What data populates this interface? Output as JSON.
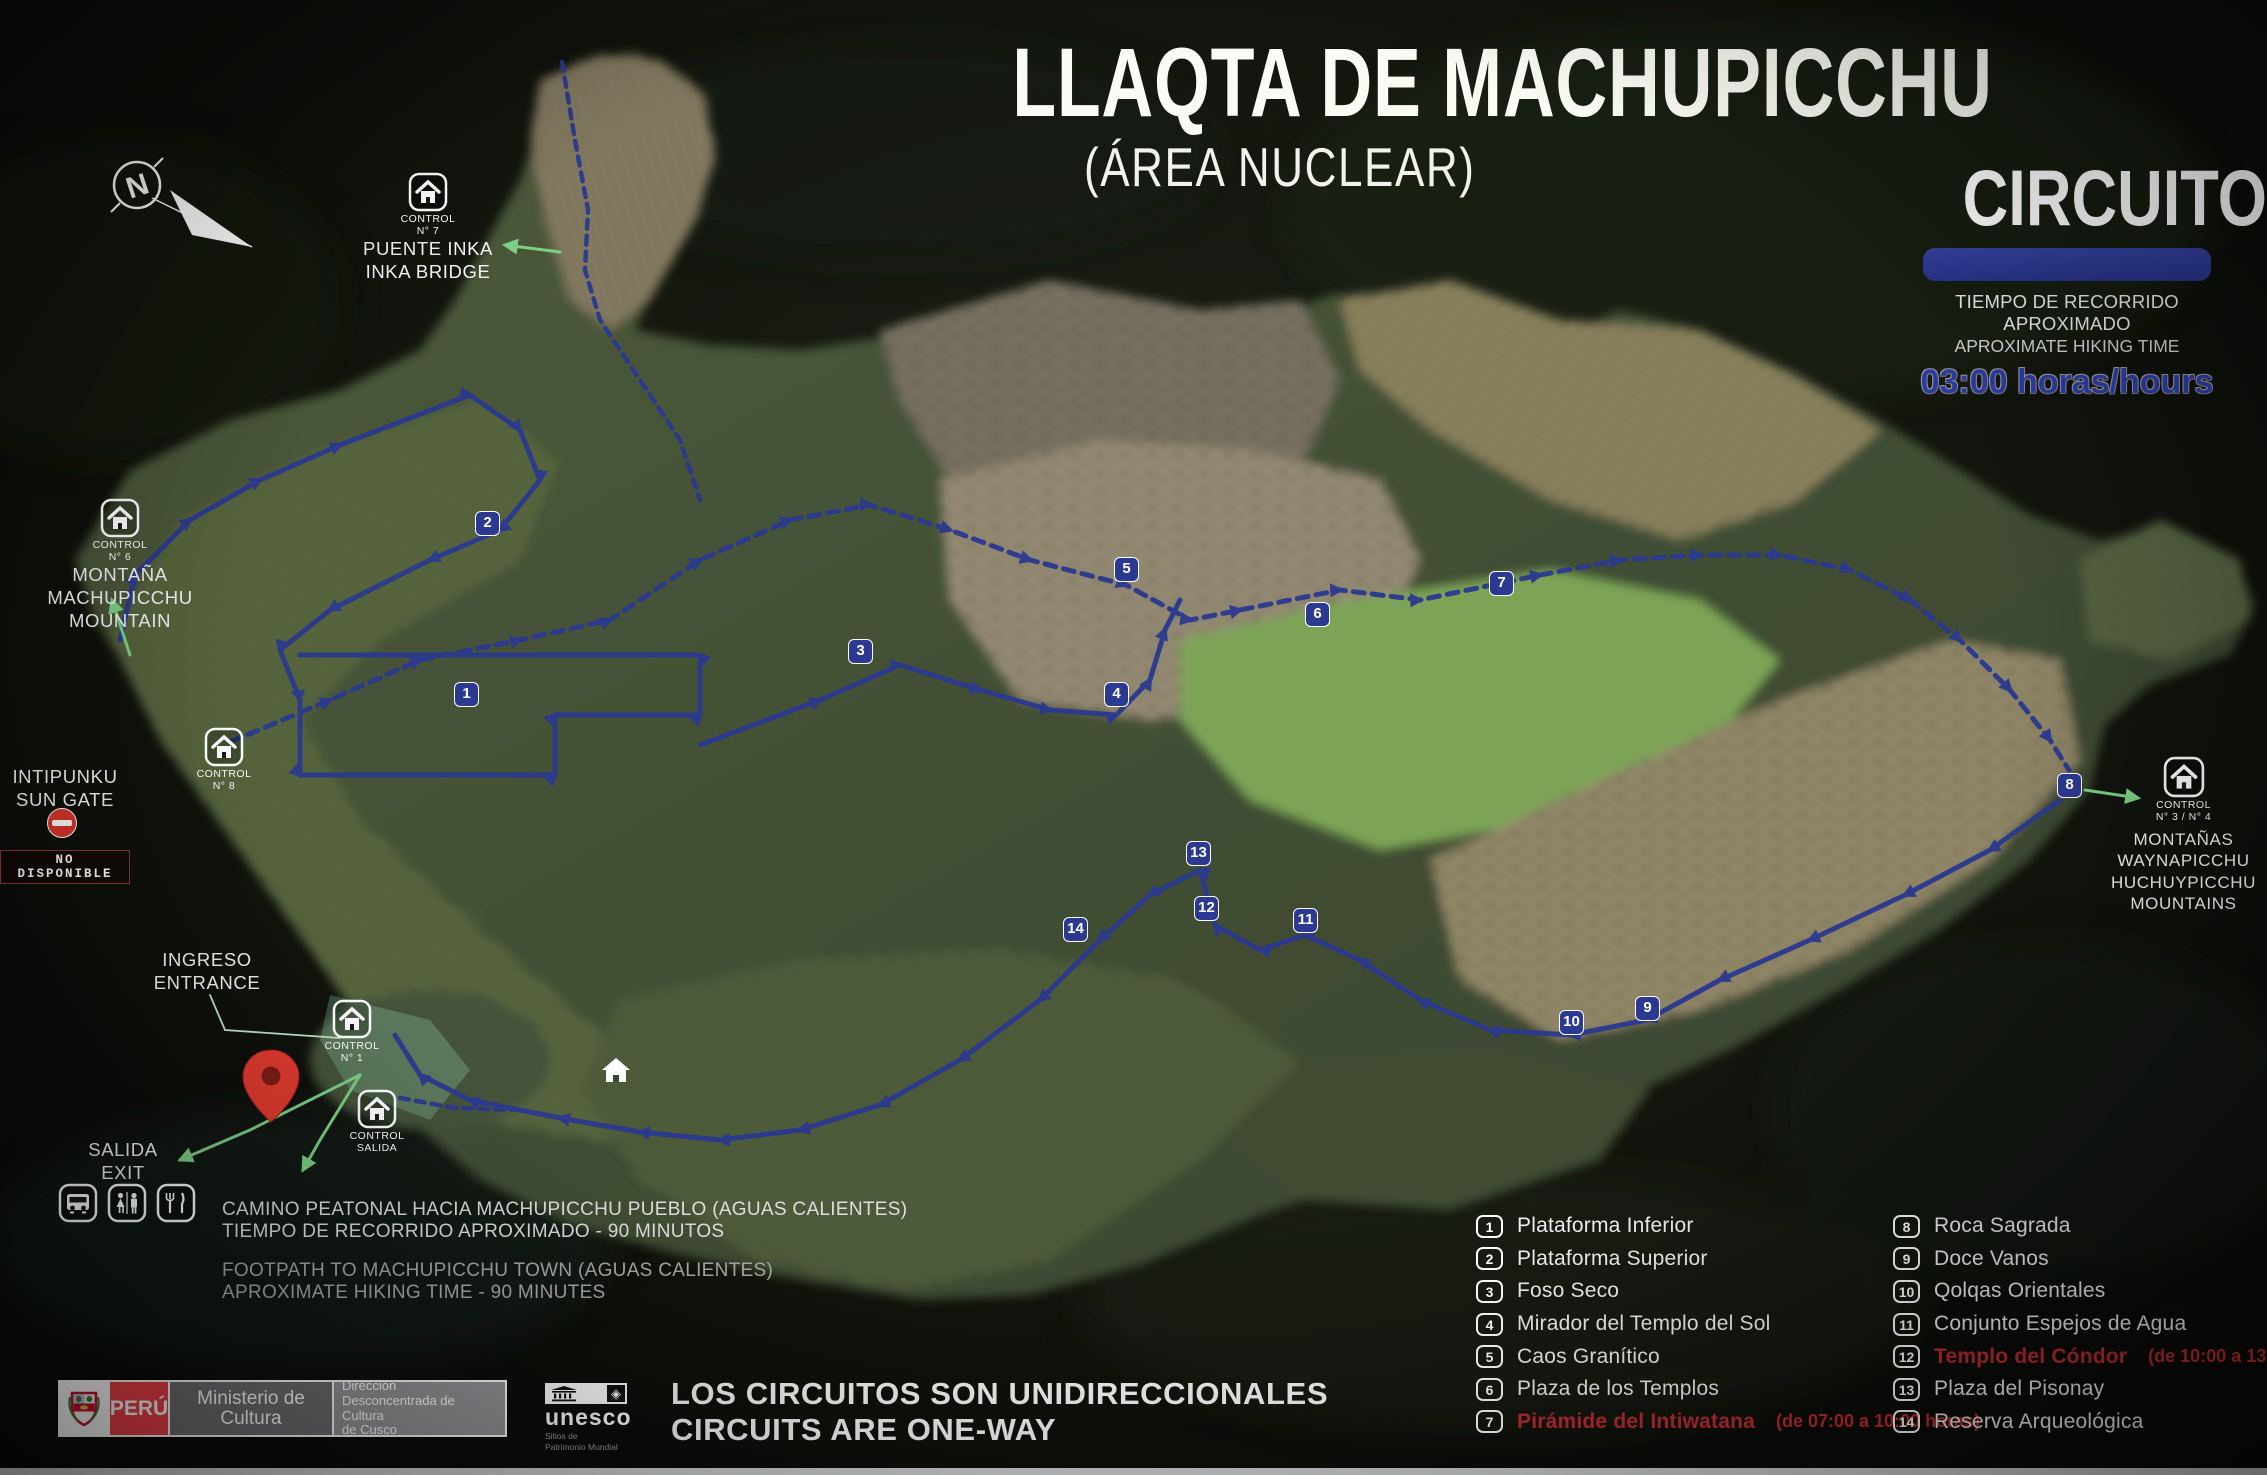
{
  "title": {
    "main": "LLAQTA DE MACHUPICCHU",
    "sub": "(ÁREA NUCLEAR)"
  },
  "circuit": {
    "name": "CIRCUITO 2",
    "es": "TIEMPO DE RECORRIDO APROXIMADO",
    "en": "APROXIMATE HIKING TIME",
    "time": "03:00 horas/hours"
  },
  "compass": {
    "letter": "N"
  },
  "landmarks": {
    "puente_inka": {
      "control": "CONTROL",
      "control_num": "N° 7",
      "line1": "PUENTE INKA",
      "line2": "INKA BRIDGE"
    },
    "montana": {
      "control": "CONTROL",
      "control_num": "N° 6",
      "line1": "MONTAÑA",
      "line2": "MACHUPICCHU",
      "line3": "MOUNTAIN"
    },
    "control8": {
      "control": "CONTROL",
      "control_num": "N° 8"
    },
    "intipunku": {
      "line1": "INTIPUNKU",
      "line2": "SUN GATE",
      "badge": "NO DISPONIBLE"
    },
    "ingreso": {
      "line1": "INGRESO",
      "line2": "ENTRANCE"
    },
    "control1": {
      "control": "CONTROL",
      "control_num": "N° 1"
    },
    "control_salida": {
      "control": "CONTROL",
      "control_num": "SALIDA"
    },
    "salida": {
      "line1": "SALIDA",
      "line2": "EXIT"
    },
    "waynapicchu": {
      "control": "CONTROL",
      "control_num": "N° 3 / N° 4",
      "line1": "MONTAÑAS",
      "line2": "WAYNAPICCHU",
      "line3": "HUCHUYPICCHU",
      "line4": "MOUNTAINS"
    }
  },
  "footpath": {
    "es1": "CAMINO PEATONAL HACIA MACHUPICCHU PUEBLO (AGUAS CALIENTES)",
    "es2": "TIEMPO DE RECORRIDO APROXIMADO - 90 MINUTOS",
    "en1": "FOOTPATH TO MACHUPICCHU TOWN (AGUAS CALIENTES)",
    "en2": "APROXIMATE HIKING TIME - 90 MINUTES"
  },
  "one_way": {
    "es": "LOS CIRCUITOS SON UNIDIRECCIONALES",
    "en": "CIRCUITS ARE ONE-WAY"
  },
  "logos": {
    "peru": "PERÚ",
    "ministerio": "Ministerio de Cultura",
    "direccion1": "Dirección",
    "direccion2": "Desconcentrada de Cultura",
    "direccion3": "de Cusco",
    "unesco": "unesco",
    "unesco_diamond": "◈",
    "unesco_sub1": "Sitios de",
    "unesco_sub2": "Patrimonio Mundial"
  },
  "legend": {
    "columns": [
      [
        {
          "n": "1",
          "label": "Plataforma Inferior",
          "note": "",
          "red": false
        },
        {
          "n": "2",
          "label": "Plataforma Superior",
          "note": "",
          "red": false
        },
        {
          "n": "3",
          "label": "Foso Seco",
          "note": "",
          "red": false
        },
        {
          "n": "4",
          "label": "Mirador del Templo del Sol",
          "note": "",
          "red": false
        },
        {
          "n": "5",
          "label": "Caos Granítico",
          "note": "",
          "red": false
        },
        {
          "n": "6",
          "label": "Plaza de los Templos",
          "note": "",
          "red": false
        },
        {
          "n": "7",
          "label": "Pirámide del Intiwatana",
          "note": "(de 07:00 a 10:00 horas)",
          "red": true
        }
      ],
      [
        {
          "n": "8",
          "label": "Roca Sagrada",
          "note": "",
          "red": false
        },
        {
          "n": "9",
          "label": "Doce Vanos",
          "note": "",
          "red": false
        },
        {
          "n": "10",
          "label": "Qolqas Orientales",
          "note": "",
          "red": false
        },
        {
          "n": "11",
          "label": "Conjunto Espejos de Agua",
          "note": "",
          "red": false
        },
        {
          "n": "12",
          "label": "Templo del Cóndor",
          "note": "(de 10:00 a 13:00 horas)",
          "red": true
        },
        {
          "n": "13",
          "label": "Plaza del Pisonay",
          "note": "",
          "red": false
        },
        {
          "n": "14",
          "label": "Reserva Arqueológica",
          "note": "",
          "red": false
        }
      ]
    ]
  },
  "map_markers": [
    {
      "n": "1",
      "x": 466,
      "y": 694
    },
    {
      "n": "2",
      "x": 487,
      "y": 523
    },
    {
      "n": "3",
      "x": 860,
      "y": 651
    },
    {
      "n": "4",
      "x": 1116,
      "y": 694
    },
    {
      "n": "5",
      "x": 1126,
      "y": 569
    },
    {
      "n": "6",
      "x": 1317,
      "y": 614
    },
    {
      "n": "7",
      "x": 1501,
      "y": 583
    },
    {
      "n": "8",
      "x": 2069,
      "y": 785
    },
    {
      "n": "9",
      "x": 1647,
      "y": 1008
    },
    {
      "n": "10",
      "x": 1571,
      "y": 1022
    },
    {
      "n": "11",
      "x": 1305,
      "y": 920
    },
    {
      "n": "12",
      "x": 1206,
      "y": 908
    },
    {
      "n": "13",
      "x": 1198,
      "y": 853
    },
    {
      "n": "14",
      "x": 1075,
      "y": 929
    }
  ],
  "colors": {
    "route_blue": "#2b3990",
    "bar_blue": "#2d3a94",
    "legend_red": "#c12b31",
    "peru_red": "#ee4048",
    "green_arrow": "#7ccf85"
  },
  "icons": {
    "compass": "north-compass-icon",
    "control": "control-house-icon",
    "no_entry": "no-entry-icon",
    "pin": "location-pin-icon",
    "bus": "bus-icon",
    "restroom": "restroom-icon",
    "restaurant": "restaurant-icon",
    "unesco_temple": "unesco-temple-icon",
    "unesco_diamond": "unesco-diamond-icon",
    "escudo": "peru-coat-of-arms-icon",
    "map_house": "house-icon"
  }
}
